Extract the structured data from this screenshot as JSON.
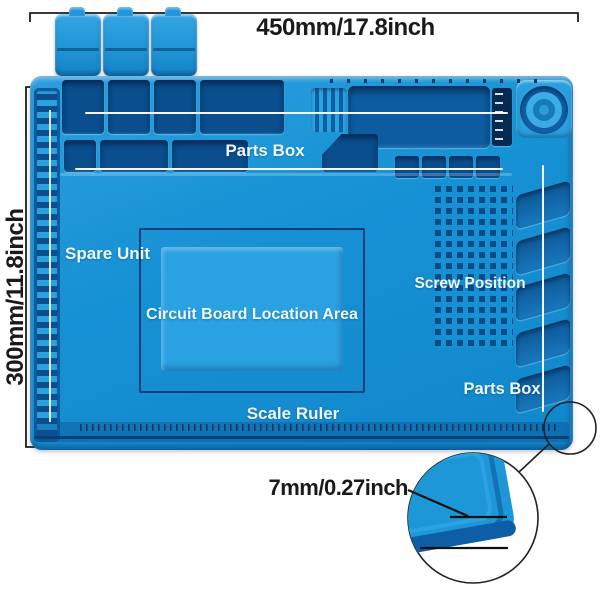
{
  "title": "Soldering mat dimension diagram",
  "annotations": {
    "width_label": "450mm/17.8inch",
    "height_label": "300mm/11.8inch",
    "thickness_label": "7mm/0.27inch"
  },
  "mat_labels": {
    "parts_box_top": "Parts Box",
    "spare_unit": "Spare Unit",
    "circuit_area": "Circuit Board Location Area",
    "screw_position": "Screw Position",
    "parts_box_right": "Parts Box",
    "scale_ruler": "Scale Ruler"
  },
  "colors": {
    "mat_base": "#1691d4",
    "mat_light": "#36a6e0",
    "pocket_dark": "#0a4e8e",
    "pocket_deep": "#083c70",
    "outline_navy": "#0a3e76",
    "label_text": "#eef7fd",
    "annotation_text": "#1a1a1a",
    "background": "#ffffff"
  }
}
